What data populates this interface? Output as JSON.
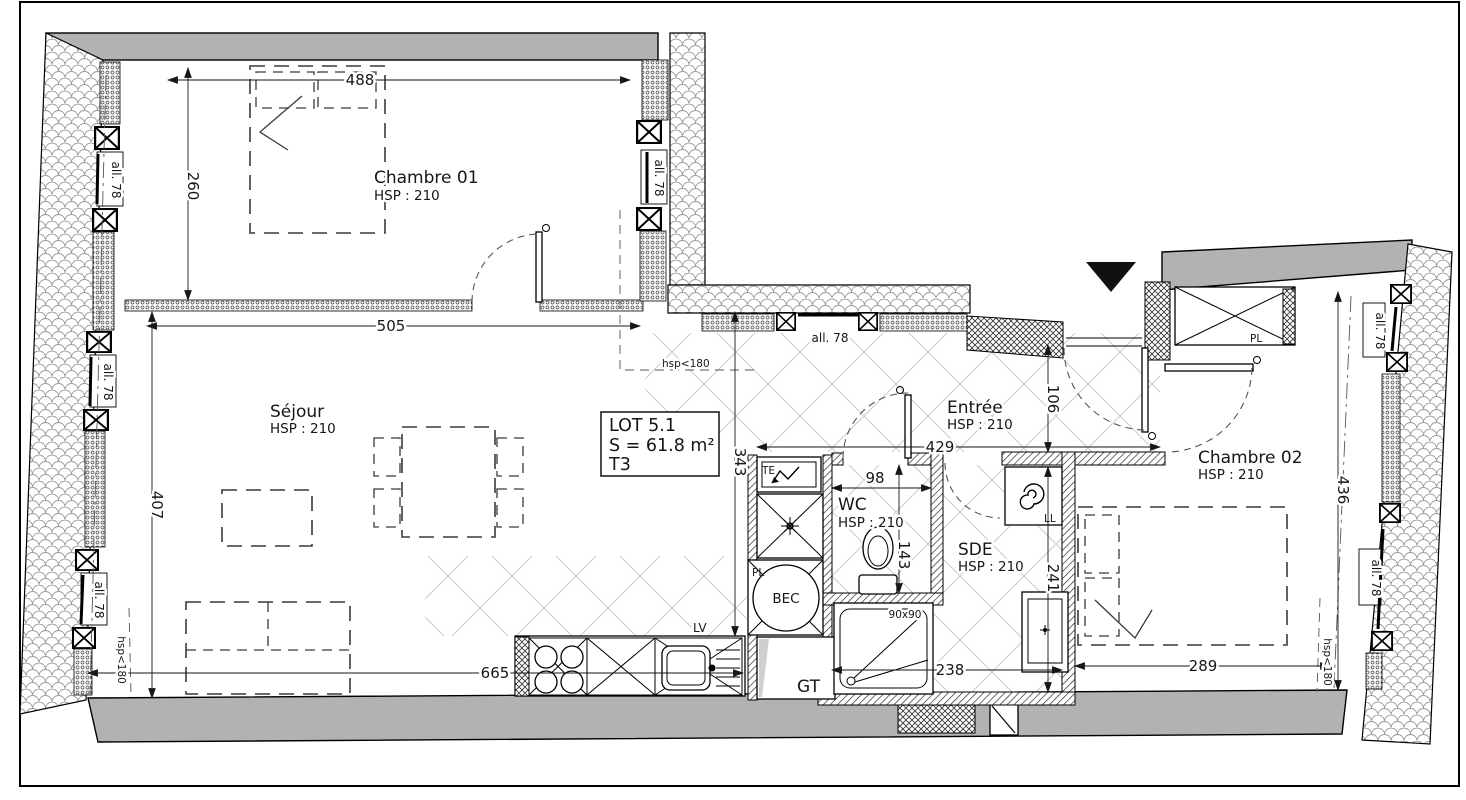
{
  "plan": {
    "lot": {
      "line1": "LOT 5.1",
      "line2": "S = 61.8 m²",
      "line3": "T3"
    },
    "rooms": {
      "chambre01": {
        "name": "Chambre 01",
        "hsp": "HSP : 210"
      },
      "sejour": {
        "name": "Séjour",
        "hsp": "HSP : 210"
      },
      "entree": {
        "name": "Entrée",
        "hsp": "HSP : 210"
      },
      "wc": {
        "name": "WC",
        "hsp": "HSP : 210"
      },
      "sde": {
        "name": "SDE",
        "hsp": "HSP : 210"
      },
      "chambre02": {
        "name": "Chambre 02",
        "hsp": "HSP : 210"
      }
    },
    "dims": {
      "d488": "488",
      "d260": "260",
      "d505": "505",
      "d407": "407",
      "d343": "343",
      "d665": "665",
      "d429": "429",
      "d106": "106",
      "d98": "98",
      "d143": "143",
      "d241": "241",
      "d238": "238",
      "d289": "289",
      "d436": "436"
    },
    "labels": {
      "allege": "all. 78",
      "hsp180": "hsp<180",
      "te": "TE",
      "pl": "PL",
      "bec": "BEC",
      "ll": "LL",
      "lv": "LV",
      "gt": "GT",
      "shower": "90x90",
      "closet": "PL"
    }
  }
}
